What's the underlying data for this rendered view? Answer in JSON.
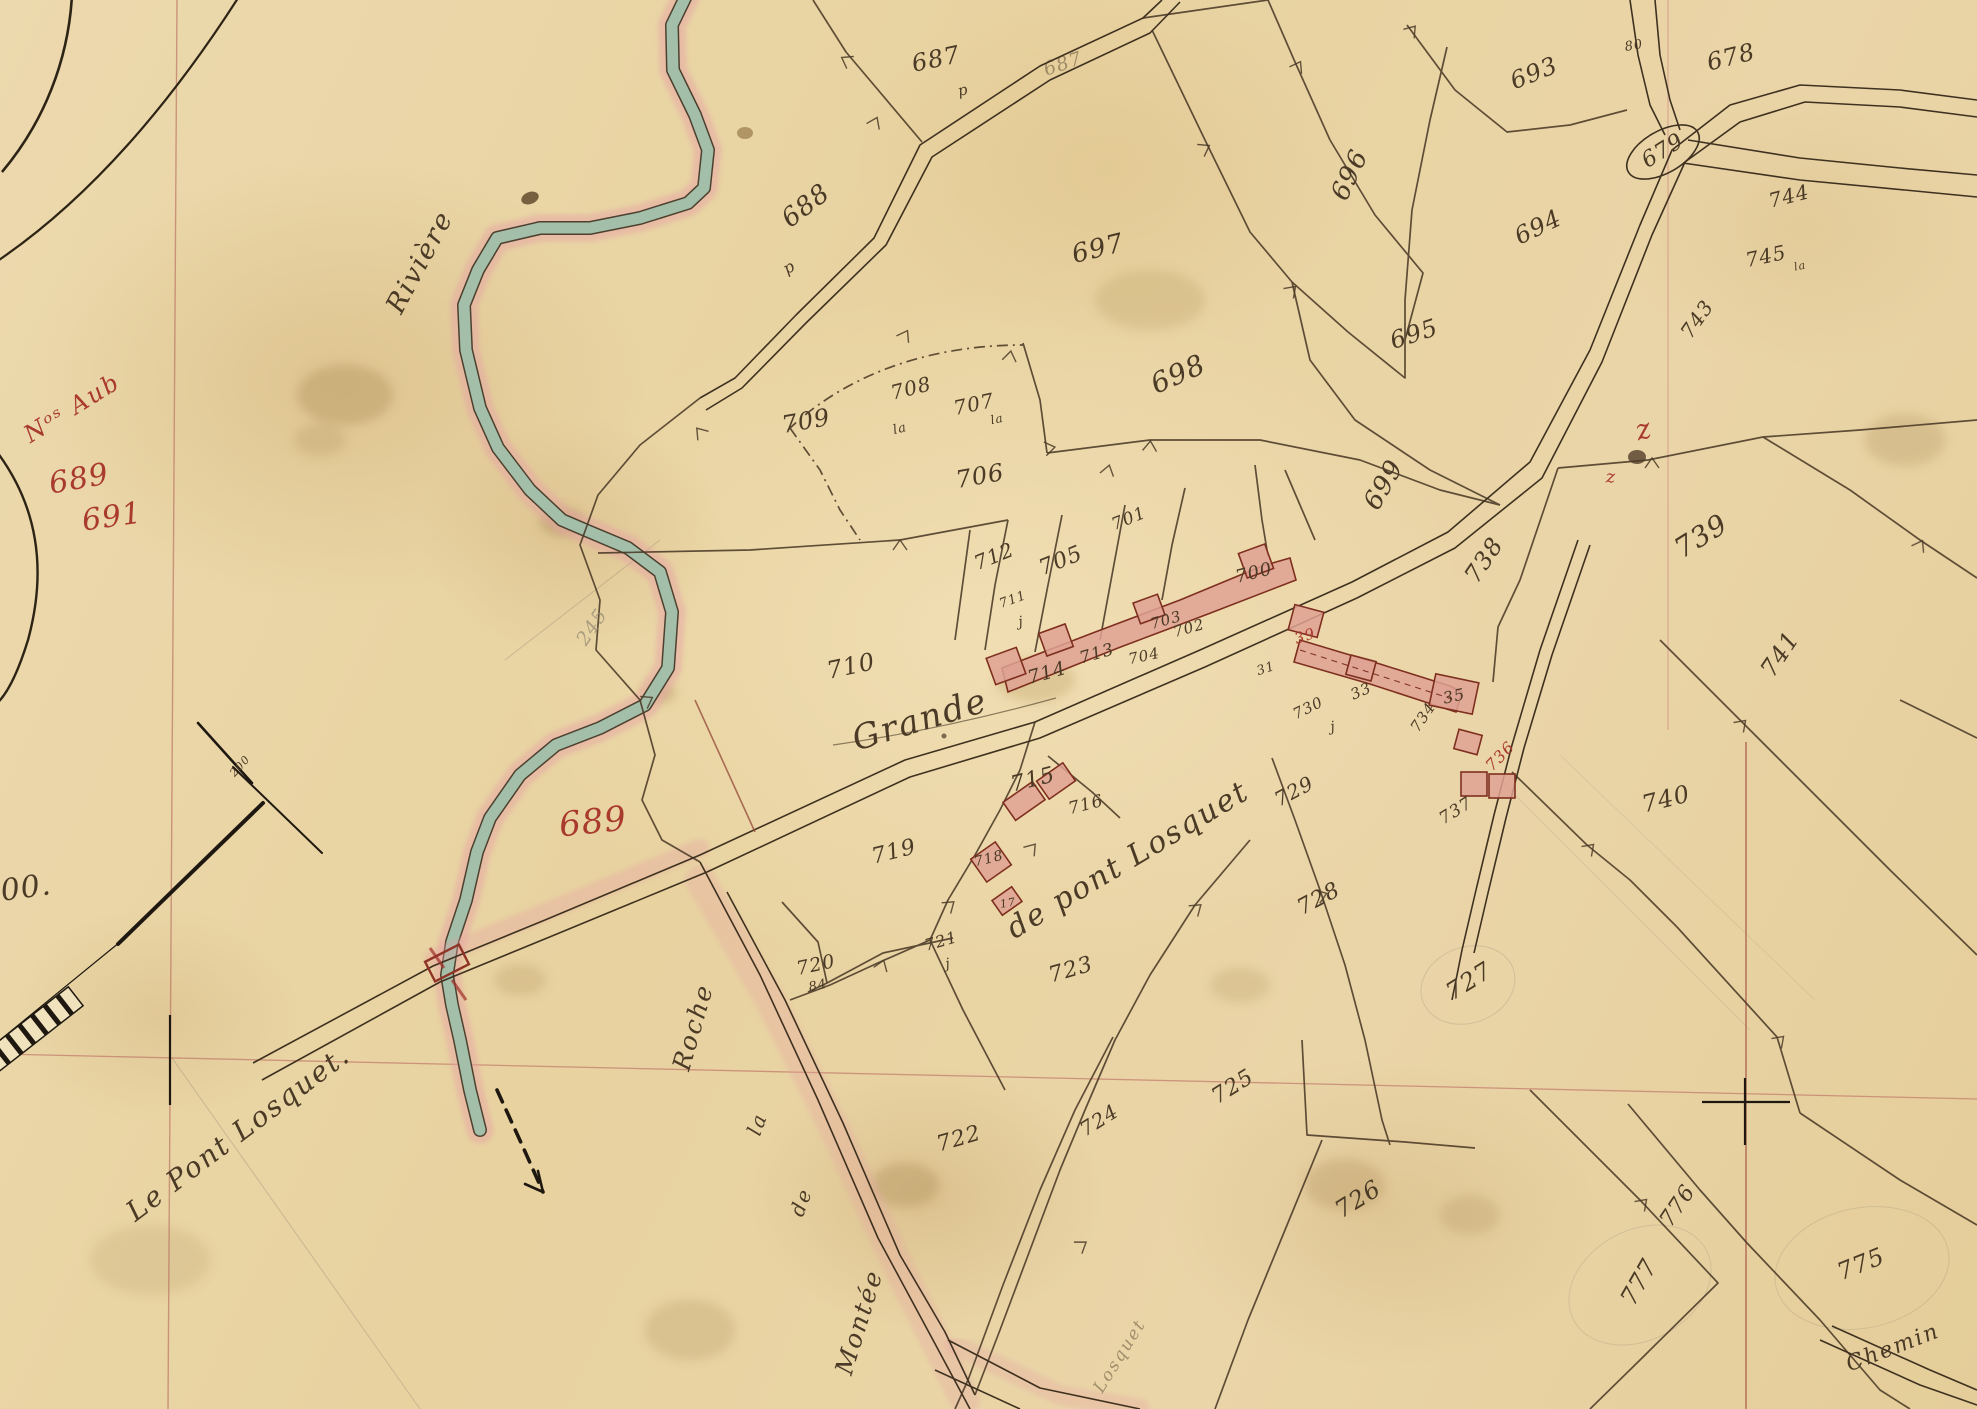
{
  "map": {
    "kind": "manuscript-cadastral-map",
    "colors": {
      "paper": "#e8d4a6",
      "ink": "#4a3a26",
      "red_ink": "#a93a2e",
      "river_fill": "#a3bfa9",
      "river_halo": "#e6a4a4",
      "building_fill": "#dfa293",
      "building_outline": "#7e2f1f",
      "grid_red": "#b5685a",
      "pencil": "#968b74"
    },
    "toponyms": [
      {
        "name": "toponym-riviere",
        "text": "Rivière",
        "x": 420,
        "y": 262,
        "size": 27,
        "rot": -62,
        "cls": "cur ink"
      },
      {
        "name": "toponym-grande-route",
        "text": "Grande",
        "x": 920,
        "y": 720,
        "size": 34,
        "rot": -17,
        "cls": "cur ink"
      },
      {
        "name": "toponym-le-pont-losquet",
        "text": "Le Pont Losquet.",
        "x": 238,
        "y": 1133,
        "size": 28,
        "rot": -37,
        "cls": "cur ink"
      },
      {
        "name": "toponym-de-pont-losquet",
        "text": "de pont Losquet",
        "x": 1128,
        "y": 860,
        "size": 30,
        "rot": -31,
        "cls": "cur ink"
      },
      {
        "name": "toponym-roche",
        "text": "Roche",
        "x": 693,
        "y": 1027,
        "size": 25,
        "rot": -74,
        "cls": "cur ink"
      },
      {
        "name": "toponym-la",
        "text": "la",
        "x": 757,
        "y": 1124,
        "size": 20,
        "rot": -70,
        "cls": "cur ink"
      },
      {
        "name": "toponym-de",
        "text": "de",
        "x": 801,
        "y": 1202,
        "size": 20,
        "rot": -70,
        "cls": "cur ink"
      },
      {
        "name": "toponym-montee",
        "text": "Montée",
        "x": 859,
        "y": 1322,
        "size": 25,
        "rot": -73,
        "cls": "cur ink"
      },
      {
        "name": "toponym-chemin",
        "text": "Chemin",
        "x": 1893,
        "y": 1348,
        "size": 22,
        "rot": -21,
        "cls": "cur ink"
      },
      {
        "name": "toponym-losquet-lane",
        "text": "Losquet",
        "x": 1120,
        "y": 1356,
        "size": 17,
        "rot": -58,
        "cls": "cur ink faint"
      }
    ],
    "parcel_numbers": [
      {
        "name": "parcel-687",
        "text": "687",
        "x": 936,
        "y": 59,
        "size": 24,
        "rot": -12
      },
      {
        "name": "parcel-687-p",
        "text": "p",
        "x": 963,
        "y": 90,
        "size": 15,
        "rot": -12
      },
      {
        "name": "parcel-687-road",
        "text": "687",
        "x": 1063,
        "y": 64,
        "size": 19,
        "rot": -18,
        "cls": "ink faint"
      },
      {
        "name": "parcel-688",
        "text": "688",
        "x": 806,
        "y": 206,
        "size": 26,
        "rot": -38
      },
      {
        "name": "parcel-688-p",
        "text": "p",
        "x": 789,
        "y": 267,
        "size": 16,
        "rot": -30
      },
      {
        "name": "parcel-697",
        "text": "697",
        "x": 1098,
        "y": 249,
        "size": 26,
        "rot": -14
      },
      {
        "name": "parcel-693",
        "text": "693",
        "x": 1534,
        "y": 73,
        "size": 24,
        "rot": -22
      },
      {
        "name": "parcel-80",
        "text": "80",
        "x": 1634,
        "y": 46,
        "size": 13,
        "rot": -10
      },
      {
        "name": "parcel-678",
        "text": "678",
        "x": 1731,
        "y": 57,
        "size": 24,
        "rot": -14
      },
      {
        "name": "parcel-696",
        "text": "696",
        "x": 1350,
        "y": 175,
        "size": 26,
        "rot": -65
      },
      {
        "name": "parcel-694",
        "text": "694",
        "x": 1538,
        "y": 227,
        "size": 24,
        "rot": -26
      },
      {
        "name": "parcel-679",
        "text": "679",
        "x": 1663,
        "y": 151,
        "size": 22,
        "rot": -32
      },
      {
        "name": "parcel-744",
        "text": "744",
        "x": 1789,
        "y": 196,
        "size": 20,
        "rot": -14
      },
      {
        "name": "parcel-745",
        "text": "745",
        "x": 1766,
        "y": 256,
        "size": 20,
        "rot": -12
      },
      {
        "name": "parcel-745-la",
        "text": "la",
        "x": 1800,
        "y": 266,
        "size": 11,
        "rot": -12
      },
      {
        "name": "parcel-743",
        "text": "743",
        "x": 1697,
        "y": 319,
        "size": 20,
        "rot": -55
      },
      {
        "name": "parcel-695",
        "text": "695",
        "x": 1414,
        "y": 334,
        "size": 24,
        "rot": -18
      },
      {
        "name": "parcel-698",
        "text": "698",
        "x": 1178,
        "y": 374,
        "size": 28,
        "rot": -24
      },
      {
        "name": "parcel-709",
        "text": "709",
        "x": 806,
        "y": 421,
        "size": 24,
        "rot": -10
      },
      {
        "name": "parcel-708",
        "text": "708",
        "x": 911,
        "y": 388,
        "size": 20,
        "rot": -14
      },
      {
        "name": "parcel-708-la",
        "text": "la",
        "x": 900,
        "y": 429,
        "size": 13,
        "rot": -14
      },
      {
        "name": "parcel-707",
        "text": "707",
        "x": 974,
        "y": 404,
        "size": 20,
        "rot": -12
      },
      {
        "name": "parcel-707-la",
        "text": "la",
        "x": 997,
        "y": 419,
        "size": 12,
        "rot": -12
      },
      {
        "name": "parcel-706",
        "text": "706",
        "x": 980,
        "y": 476,
        "size": 24,
        "rot": -10
      },
      {
        "name": "parcel-699",
        "text": "699",
        "x": 1384,
        "y": 485,
        "size": 26,
        "rot": -60
      },
      {
        "name": "parcel-701",
        "text": "701",
        "x": 1129,
        "y": 519,
        "size": 17,
        "rot": -22
      },
      {
        "name": "parcel-705",
        "text": "705",
        "x": 1061,
        "y": 561,
        "size": 22,
        "rot": -22
      },
      {
        "name": "parcel-712",
        "text": "712",
        "x": 994,
        "y": 556,
        "size": 20,
        "rot": -22
      },
      {
        "name": "parcel-700",
        "text": "700",
        "x": 1254,
        "y": 573,
        "size": 18,
        "rot": -14
      },
      {
        "name": "parcel-703",
        "text": "703",
        "x": 1166,
        "y": 620,
        "size": 15,
        "rot": -16
      },
      {
        "name": "parcel-702",
        "text": "702",
        "x": 1189,
        "y": 628,
        "size": 15,
        "rot": -16
      },
      {
        "name": "parcel-704",
        "text": "704",
        "x": 1144,
        "y": 656,
        "size": 15,
        "rot": -12
      },
      {
        "name": "parcel-713",
        "text": "713",
        "x": 1097,
        "y": 654,
        "size": 17,
        "rot": -16
      },
      {
        "name": "parcel-714",
        "text": "714",
        "x": 1047,
        "y": 673,
        "size": 19,
        "rot": -16
      },
      {
        "name": "parcel-711",
        "text": "711",
        "x": 1013,
        "y": 600,
        "size": 13,
        "rot": -20
      },
      {
        "name": "parcel-711-j",
        "text": "j",
        "x": 1021,
        "y": 622,
        "size": 14,
        "rot": -10
      },
      {
        "name": "parcel-710",
        "text": "710",
        "x": 851,
        "y": 666,
        "size": 24,
        "rot": -12
      },
      {
        "name": "parcel-738",
        "text": "738",
        "x": 1484,
        "y": 560,
        "size": 24,
        "rot": -56
      },
      {
        "name": "parcel-739",
        "text": "739",
        "x": 1701,
        "y": 536,
        "size": 28,
        "rot": -32
      },
      {
        "name": "parcel-741",
        "text": "741",
        "x": 1780,
        "y": 654,
        "size": 24,
        "rot": -56
      },
      {
        "name": "parcel-730",
        "text": "730",
        "x": 1308,
        "y": 708,
        "size": 15,
        "rot": -26
      },
      {
        "name": "parcel-730-j",
        "text": "j",
        "x": 1333,
        "y": 727,
        "size": 14,
        "rot": -10
      },
      {
        "name": "parcel-734",
        "text": "734",
        "x": 1423,
        "y": 717,
        "size": 15,
        "rot": -56
      },
      {
        "name": "parcel-737",
        "text": "737",
        "x": 1456,
        "y": 811,
        "size": 17,
        "rot": -32
      },
      {
        "name": "parcel-740",
        "text": "740",
        "x": 1666,
        "y": 799,
        "size": 24,
        "rot": -14
      },
      {
        "name": "parcel-715",
        "text": "715",
        "x": 1033,
        "y": 780,
        "size": 22,
        "rot": -14
      },
      {
        "name": "parcel-716",
        "text": "716",
        "x": 1086,
        "y": 805,
        "size": 17,
        "rot": -14
      },
      {
        "name": "parcel-718",
        "text": "718",
        "x": 989,
        "y": 859,
        "size": 14,
        "rot": -14
      },
      {
        "name": "parcel-17",
        "text": "17",
        "x": 1008,
        "y": 903,
        "size": 11,
        "rot": -10
      },
      {
        "name": "parcel-719",
        "text": "719",
        "x": 894,
        "y": 852,
        "size": 22,
        "rot": -14
      },
      {
        "name": "parcel-720",
        "text": "720",
        "x": 816,
        "y": 965,
        "size": 19,
        "rot": -12
      },
      {
        "name": "parcel-720-84",
        "text": "84",
        "x": 818,
        "y": 986,
        "size": 13,
        "rot": -12
      },
      {
        "name": "parcel-721",
        "text": "721",
        "x": 941,
        "y": 941,
        "size": 16,
        "rot": -16
      },
      {
        "name": "parcel-721-j",
        "text": "j",
        "x": 948,
        "y": 964,
        "size": 14,
        "rot": -10
      },
      {
        "name": "parcel-722",
        "text": "722",
        "x": 959,
        "y": 1139,
        "size": 22,
        "rot": -16
      },
      {
        "name": "parcel-723",
        "text": "723",
        "x": 1071,
        "y": 970,
        "size": 22,
        "rot": -16
      },
      {
        "name": "parcel-729",
        "text": "729",
        "x": 1294,
        "y": 791,
        "size": 20,
        "rot": -28
      },
      {
        "name": "parcel-728",
        "text": "728",
        "x": 1319,
        "y": 899,
        "size": 22,
        "rot": -28
      },
      {
        "name": "parcel-727",
        "text": "727",
        "x": 1469,
        "y": 981,
        "size": 24,
        "rot": -32
      },
      {
        "name": "parcel-725",
        "text": "725",
        "x": 1233,
        "y": 1087,
        "size": 22,
        "rot": -32
      },
      {
        "name": "parcel-724",
        "text": "724",
        "x": 1099,
        "y": 1120,
        "size": 20,
        "rot": -32
      },
      {
        "name": "parcel-726",
        "text": "726",
        "x": 1358,
        "y": 1199,
        "size": 24,
        "rot": -32
      },
      {
        "name": "parcel-777",
        "text": "777",
        "x": 1639,
        "y": 1282,
        "size": 24,
        "rot": -60
      },
      {
        "name": "parcel-776",
        "text": "776",
        "x": 1678,
        "y": 1206,
        "size": 22,
        "rot": -56
      },
      {
        "name": "parcel-775",
        "text": "775",
        "x": 1861,
        "y": 1264,
        "size": 24,
        "rot": -22
      },
      {
        "name": "parcel-33",
        "text": "33",
        "x": 1361,
        "y": 691,
        "size": 15,
        "rot": -24
      },
      {
        "name": "parcel-35",
        "text": "35",
        "x": 1454,
        "y": 696,
        "size": 16,
        "rot": -12
      },
      {
        "name": "parcel-31",
        "text": "31",
        "x": 1266,
        "y": 669,
        "size": 13,
        "rot": -18
      }
    ],
    "annotations_red": [
      {
        "name": "red-note-nos-aub",
        "text": "Nᵒˢ Aub",
        "x": 72,
        "y": 408,
        "size": 24,
        "rot": -32,
        "cls": "cur red"
      },
      {
        "name": "red-689-margin",
        "text": "689",
        "x": 79,
        "y": 479,
        "size": 30,
        "rot": -10,
        "cls": "red"
      },
      {
        "name": "red-691-margin",
        "text": "691",
        "x": 112,
        "y": 517,
        "size": 30,
        "rot": -8,
        "cls": "red"
      },
      {
        "name": "red-689-river",
        "text": "689",
        "x": 593,
        "y": 822,
        "size": 34,
        "rot": -6,
        "cls": "red"
      },
      {
        "name": "red-z-script",
        "text": "z",
        "x": 1644,
        "y": 429,
        "size": 28,
        "rot": -15,
        "cls": "cur red"
      },
      {
        "name": "red-z-small",
        "text": "z",
        "x": 1611,
        "y": 477,
        "size": 18,
        "rot": 0,
        "cls": "red"
      },
      {
        "name": "red-39",
        "text": "39",
        "x": 1305,
        "y": 636,
        "size": 15,
        "rot": -18,
        "cls": "red"
      },
      {
        "name": "red-736",
        "text": "736",
        "x": 1500,
        "y": 756,
        "size": 16,
        "rot": -46,
        "cls": "red"
      }
    ],
    "survey_marks": [
      {
        "name": "survey-00",
        "text": "00.",
        "x": 26,
        "y": 888,
        "size": 30,
        "rot": -8,
        "cls": "ink"
      },
      {
        "name": "survey-200",
        "text": "200",
        "x": 240,
        "y": 766,
        "size": 11,
        "rot": -48,
        "cls": "ink"
      },
      {
        "name": "pencil-245",
        "text": "245",
        "x": 592,
        "y": 627,
        "size": 19,
        "rot": -56,
        "cls": "pencil"
      }
    ]
  }
}
